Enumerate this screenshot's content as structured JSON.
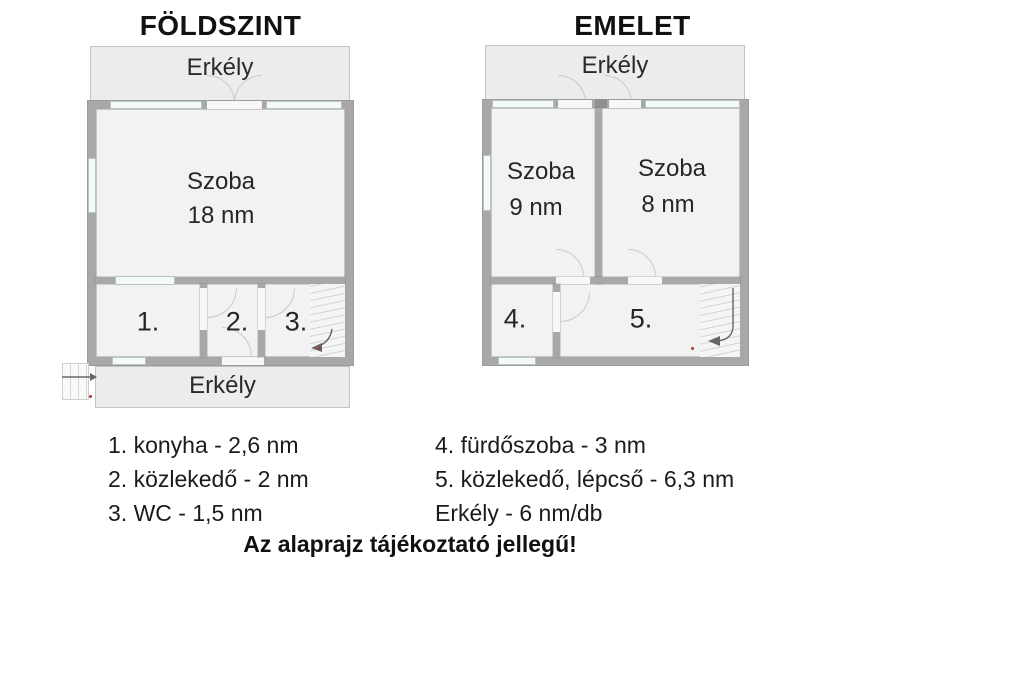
{
  "colors": {
    "wall": "#a8a8a8",
    "wall_dark": "#8f8f8f",
    "room_fill": "#f2f2f2",
    "balcony_fill": "#ececec",
    "window_fill": "#f3faf7",
    "text": "#1a1a1a",
    "arrow": "#666666",
    "red_mark": "#b03a2e"
  },
  "floor_plans": [
    {
      "title": "FÖLDSZINT",
      "balconies": {
        "top": "Erkély",
        "bottom": "Erkély"
      },
      "main_room": {
        "name": "Szoba",
        "area": "18 nm"
      },
      "numbered_rooms": [
        "1.",
        "2.",
        "3."
      ]
    },
    {
      "title": "EMELET",
      "balconies": {
        "top": "Erkély"
      },
      "rooms": [
        {
          "name": "Szoba",
          "area": "9 nm"
        },
        {
          "name": "Szoba",
          "area": "8 nm"
        }
      ],
      "numbered_rooms": [
        "4.",
        "5."
      ]
    }
  ],
  "legend": {
    "left_column": [
      "1. konyha - 2,6 nm",
      "2. közlekedő - 2 nm",
      "3. WC - 1,5 nm"
    ],
    "right_column": [
      "4. fürdőszoba - 3 nm",
      "5. közlekedő, lépcső - 6,3 nm",
      "Erkély - 6 nm/db"
    ]
  },
  "footer_note": "Az alaprajz tájékoztató jellegű!"
}
